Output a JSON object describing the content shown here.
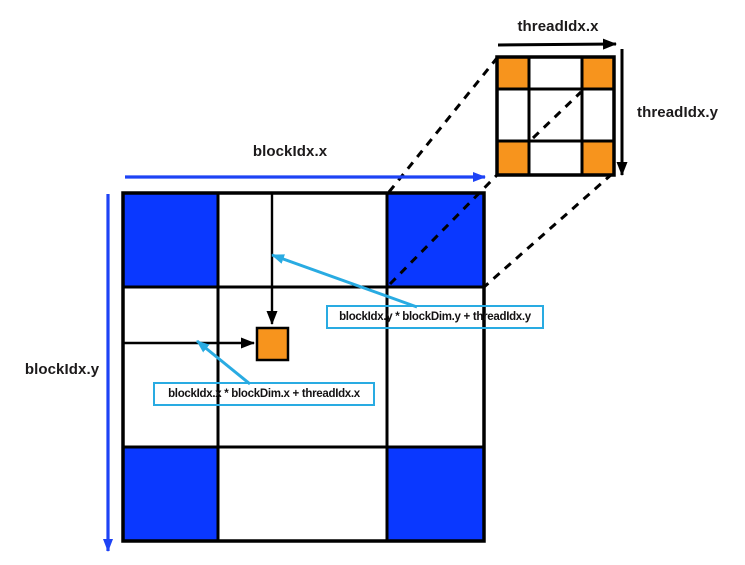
{
  "labels": {
    "threadidx_x": "threadIdx.x",
    "threadidx_y": "threadIdx.y",
    "blockidx_x": "blockIdx.x",
    "blockidx_y": "blockIdx.y"
  },
  "formulas": {
    "y_index": "blockIdx.y * blockDim.y + threadIdx.y",
    "x_index": "blockIdx.x * blockDim.x + threadIdx.x"
  },
  "block_grid": {
    "rows": 3,
    "cols": 3,
    "fill_matrix": [
      [
        "blue",
        "white",
        "blue"
      ],
      [
        "white",
        "white",
        "white"
      ],
      [
        "blue",
        "white",
        "blue"
      ]
    ]
  },
  "thread_grid": {
    "rows": 3,
    "cols": 3,
    "fill_matrix": [
      [
        "orange",
        "white",
        "orange"
      ],
      [
        "white",
        "white",
        "white"
      ],
      [
        "orange",
        "white",
        "orange"
      ]
    ]
  },
  "highlight_cell": {
    "fill": "orange"
  },
  "colors": {
    "blue": "#0a38ff",
    "orange": "#f7941d",
    "white": "#ffffff",
    "arrow_blue": "#1e43f5",
    "callout_cyan": "#29abe2",
    "black": "#000000",
    "background": "#ffffff"
  }
}
